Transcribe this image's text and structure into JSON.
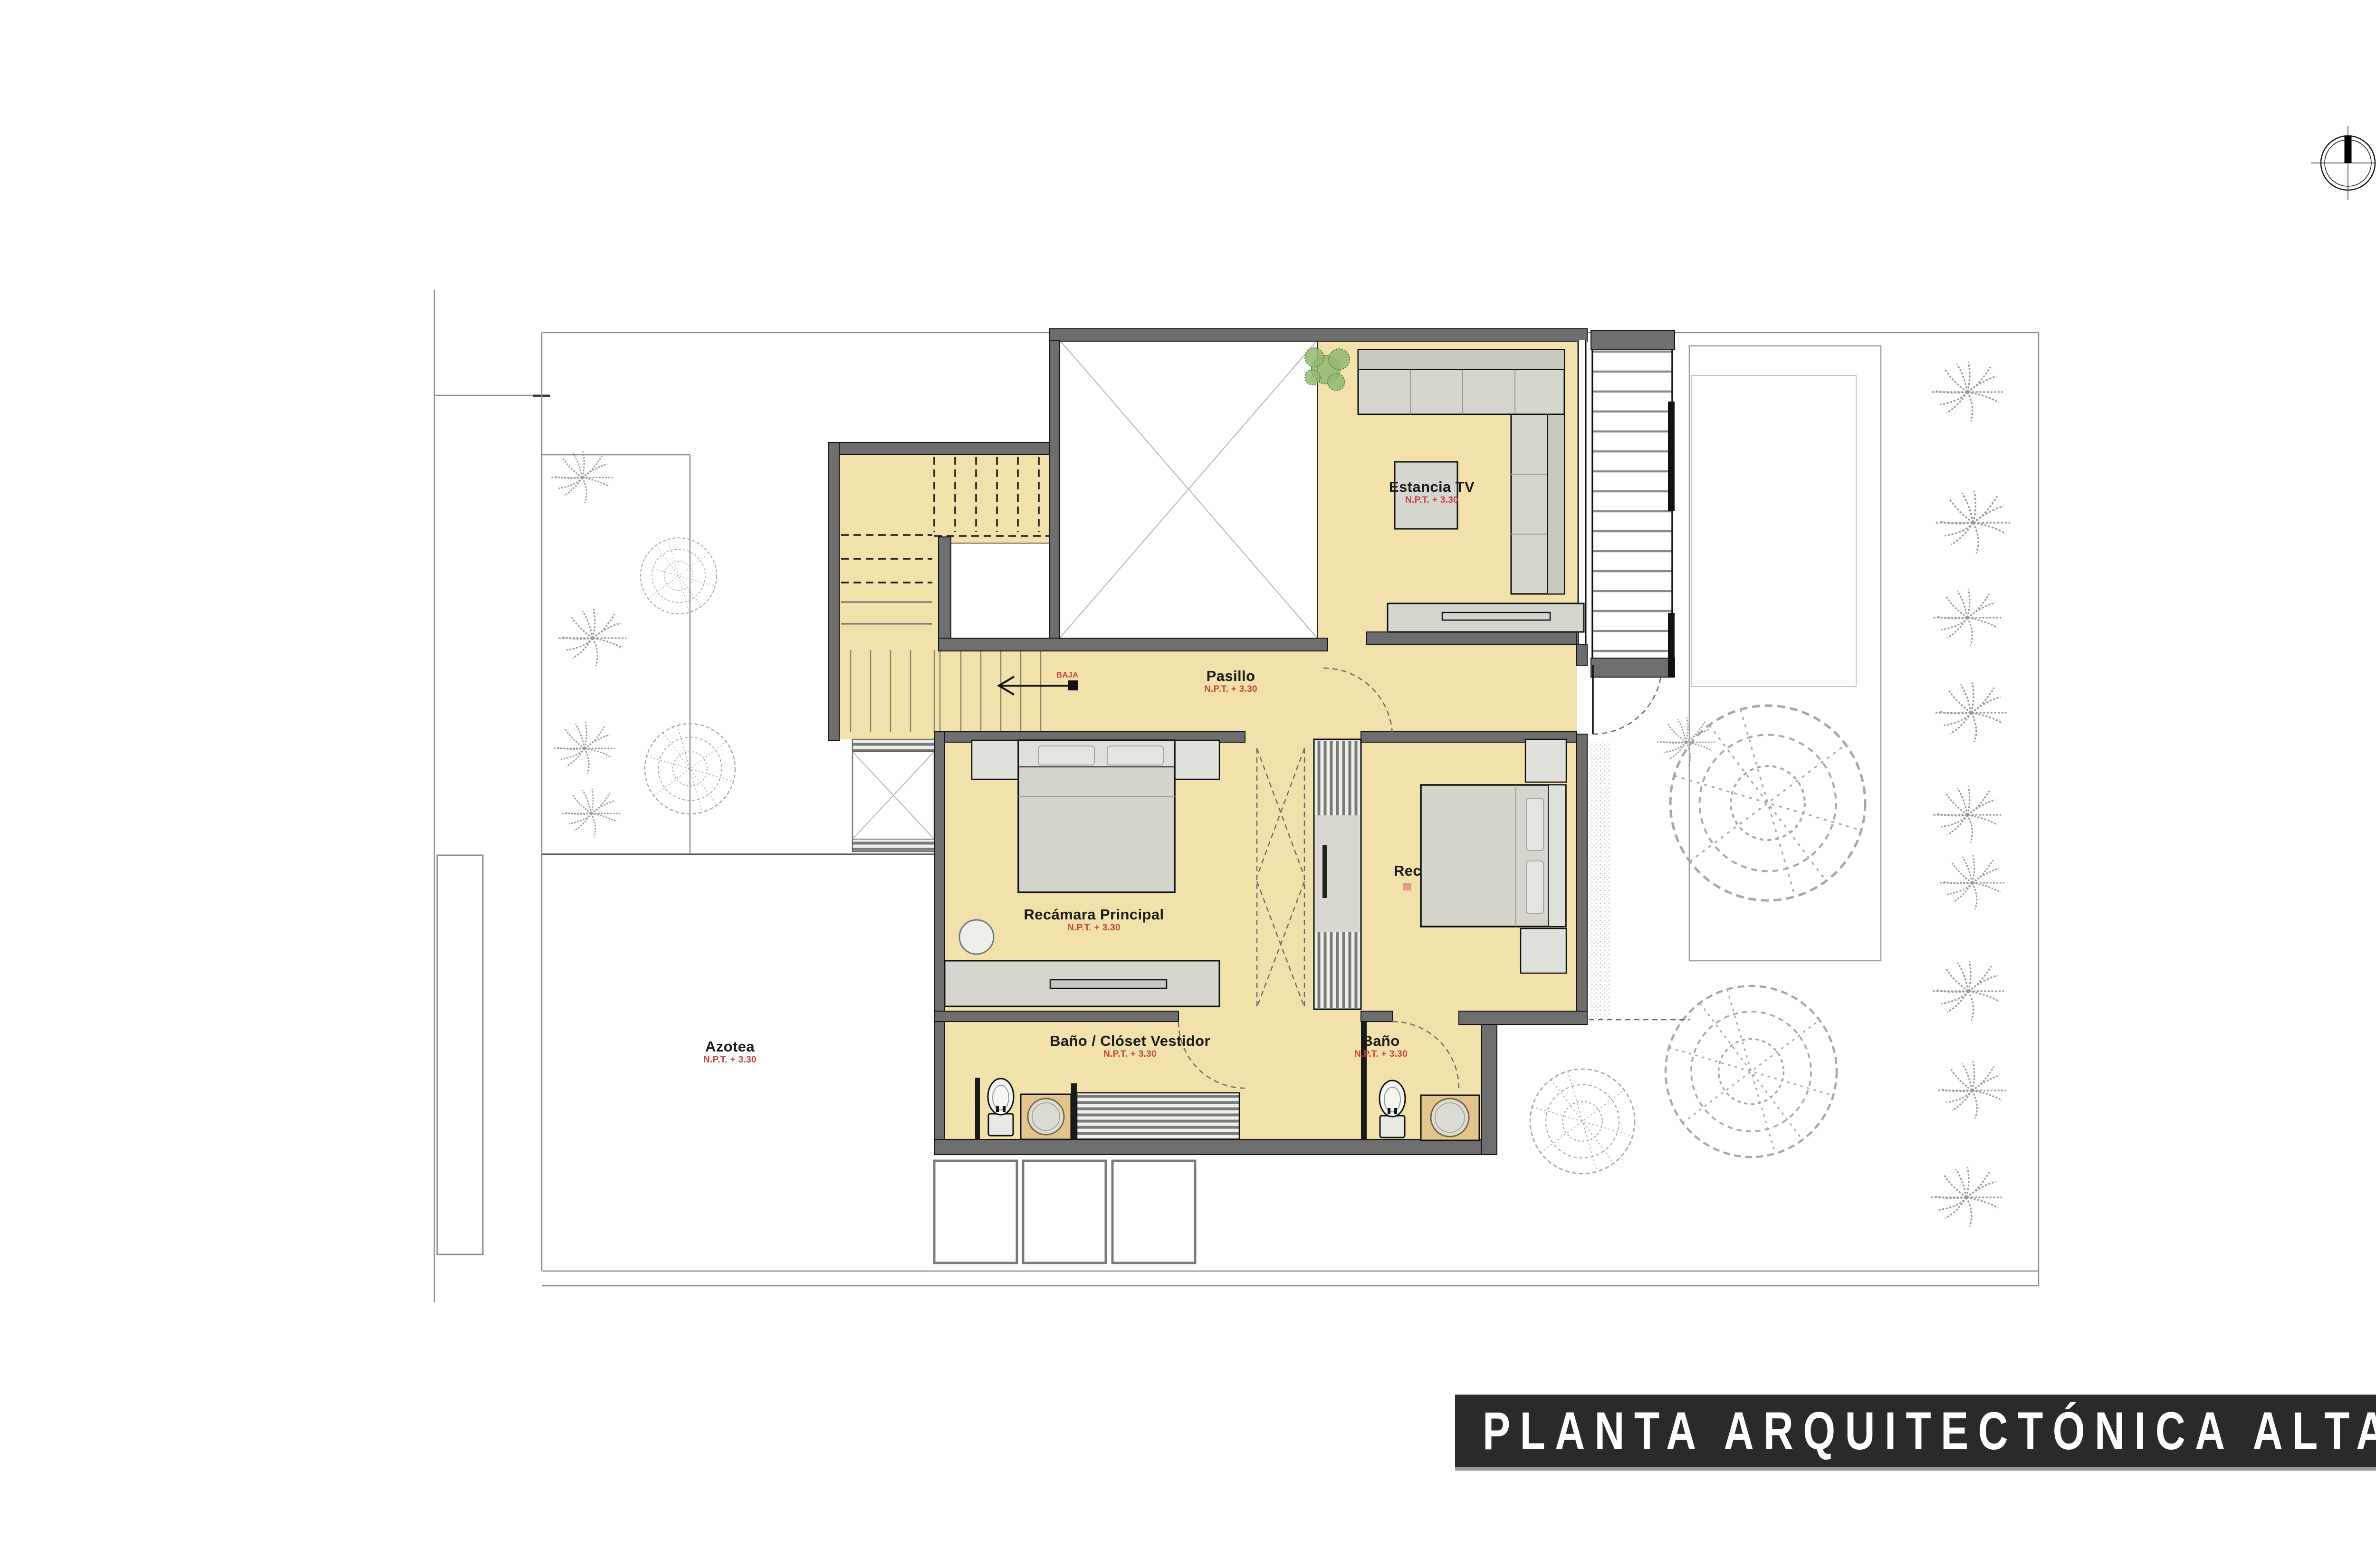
{
  "title_bar": {
    "text": "PLANTA ARQUITECTÓNICA ALTA"
  },
  "rooms": {
    "estancia_tv": {
      "label": "Estancia TV",
      "level": "N.P.T. + 3.30"
    },
    "pasillo": {
      "label": "Pasillo",
      "level": "N.P.T. + 3.30"
    },
    "recamara_principal": {
      "label": "Recámara Principal",
      "level": "N.P.T. + 3.30"
    },
    "bano_closet_vestidor": {
      "label": "Baño / Clóset Vestidor",
      "level": "N.P.T. + 3.30"
    },
    "bano": {
      "label": "Baño",
      "level": "N.P.T. + 3.30"
    },
    "azotea": {
      "label": "Azotea",
      "level": "N.P.T. + 3.30"
    },
    "recamara_secundaria": {
      "label": "Rec"
    }
  },
  "stairs": {
    "direction_label": "BAJA"
  },
  "colors": {
    "floor": "#F2E1AB",
    "wall": "#6E6E6E",
    "accent_red": "#C2453C",
    "furn": "#D6D6CE",
    "tree": "#9C9C9C",
    "title_bg": "#2A2A2A",
    "title_fg": "#FFFFFF"
  }
}
